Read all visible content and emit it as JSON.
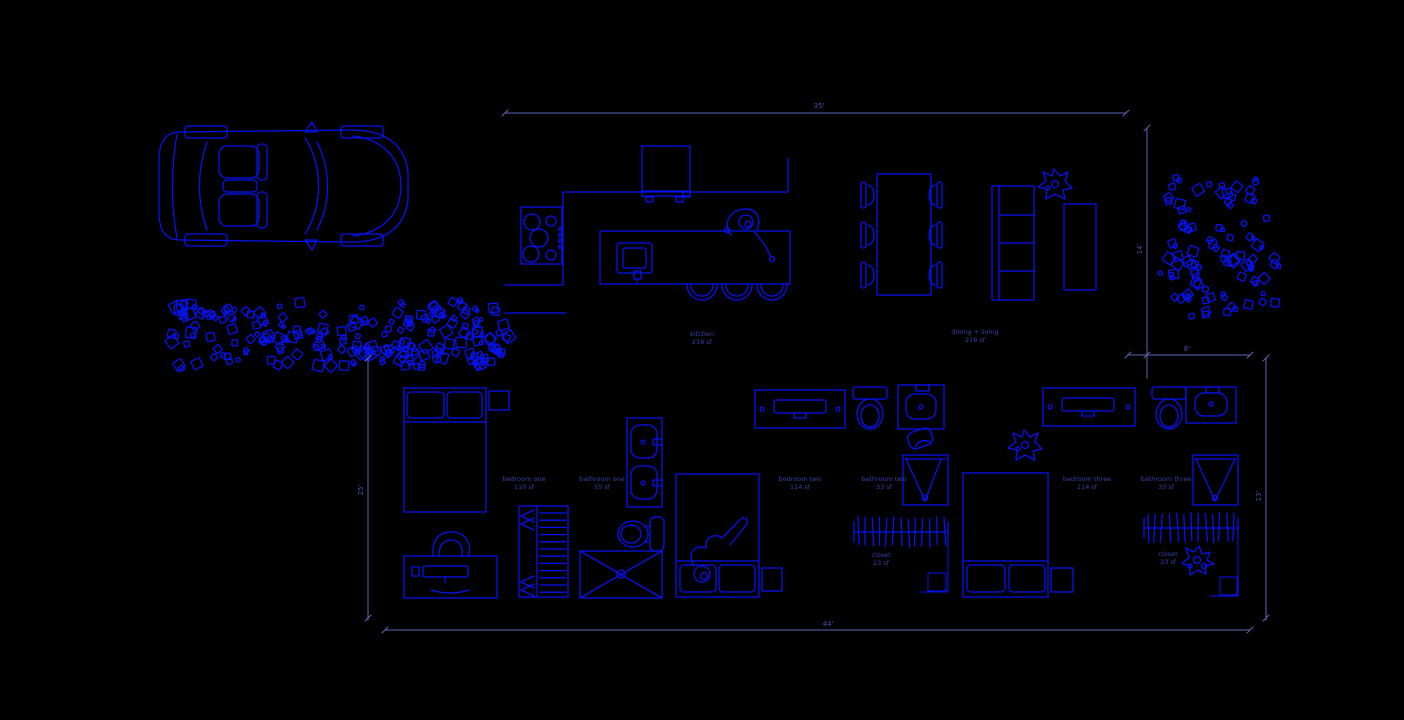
{
  "colors": {
    "background": "#000000",
    "linework": "#0613f0",
    "dimension": "#5a66b2",
    "annotation": "#3642a8",
    "dimtext": "#4450b0"
  },
  "rooms": [
    {
      "name": "kitchen",
      "area": "216 sf"
    },
    {
      "name": "dining + living",
      "area": "216 sf"
    },
    {
      "name": "bedroom one",
      "area": "110 sf"
    },
    {
      "name": "bathroom one",
      "area": "55 sf"
    },
    {
      "name": "bedroom two",
      "area": "114 sf"
    },
    {
      "name": "bathroom two",
      "area": "33 sf"
    },
    {
      "name": "closet",
      "area": "23 sf"
    },
    {
      "name": "bedroom three",
      "area": "114 sf"
    },
    {
      "name": "bathroom three",
      "area": "33 sf"
    },
    {
      "name": "closet",
      "area": "23 sf"
    }
  ],
  "dimensions": {
    "top": "35'",
    "right_upper": "14'",
    "right_offset": "8'",
    "right_lower": "13'",
    "left": "25'",
    "bottom": "44'"
  },
  "blocks": [
    "car-top-view",
    "shrub-scatter-row",
    "shrub-scatter-cluster",
    "refrigerator",
    "cooktop",
    "kitchen-island-with-sink",
    "bar-stool",
    "person-figure",
    "dining-table-with-chairs",
    "bookshelf",
    "potted-plant",
    "console-table",
    "double-bed",
    "nightstand",
    "desk-with-chair",
    "wardrobe-shelving",
    "double-sink-vanity",
    "toilet",
    "shower-pan",
    "dresser-with-tv",
    "bed-with-person",
    "single-sink-vanity",
    "corner-shower",
    "closet-rod-with-hangers"
  ]
}
